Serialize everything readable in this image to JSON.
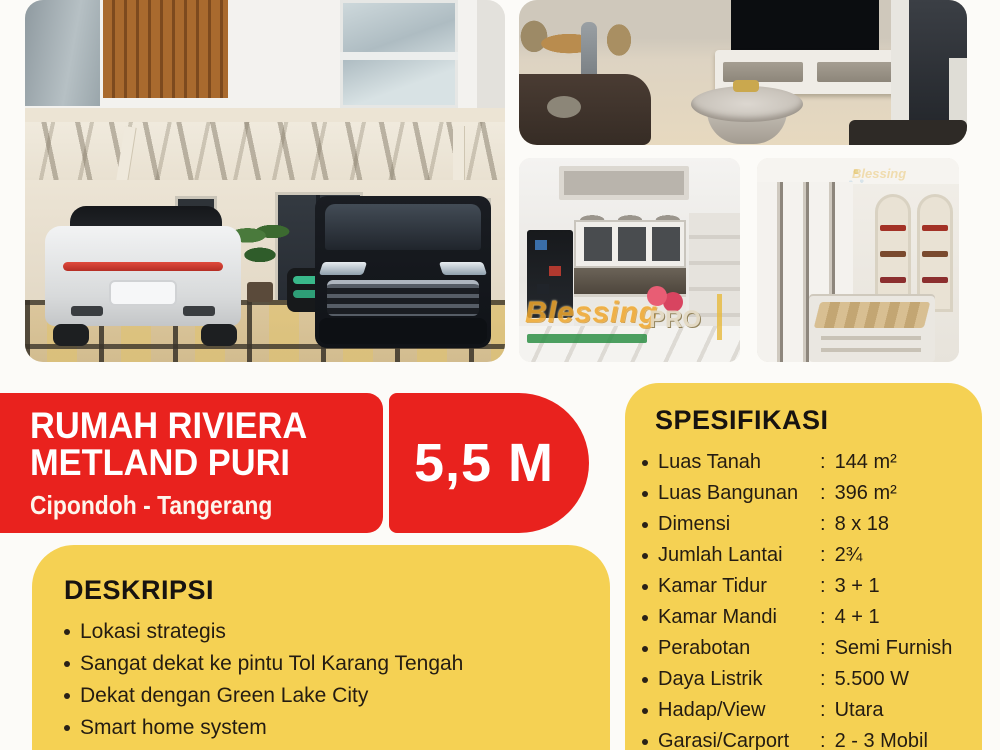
{
  "poster": {
    "title_line1": "RUMAH RIVIERA",
    "title_line2": "METLAND PURI",
    "location": "Cipondoh - Tangerang",
    "price": "5,5 M"
  },
  "spesifikasi": {
    "heading": "SPESIFIKASI",
    "colon": ":",
    "items": [
      {
        "label": "Luas Tanah",
        "value": "144 m²"
      },
      {
        "label": "Luas Bangunan",
        "value": "396 m²"
      },
      {
        "label": "Dimensi",
        "value": "8 x 18"
      },
      {
        "label": "Jumlah Lantai",
        "value": "2¾"
      },
      {
        "label": "Kamar Tidur",
        "value": "3 + 1"
      },
      {
        "label": "Kamar Mandi",
        "value": "4 + 1"
      },
      {
        "label": "Perabotan",
        "value": "Semi Furnish"
      },
      {
        "label": "Daya Listrik",
        "value": "5.500 W"
      },
      {
        "label": "Hadap/View",
        "value": "Utara"
      },
      {
        "label": "Garasi/Carport",
        "value": "2 - 3 Mobil"
      }
    ]
  },
  "deskripsi": {
    "heading": "DESKRIPSI",
    "items": [
      "Lokasi strategis",
      "Sangat dekat ke pintu Tol Karang Tengah",
      "Dekat dengan Green Lake City",
      "Smart home system",
      "Sistem keamanan digital + security 24 jam"
    ]
  },
  "watermark": {
    "brand": "Blessing",
    "suffix": "PRO"
  },
  "colors": {
    "red": "#e9221e",
    "yellow": "#f5d153",
    "text_dark": "#241c12",
    "white": "#ffffff",
    "watermark_orange": "#f0a72c",
    "watermark_green": "#2e8f46"
  }
}
